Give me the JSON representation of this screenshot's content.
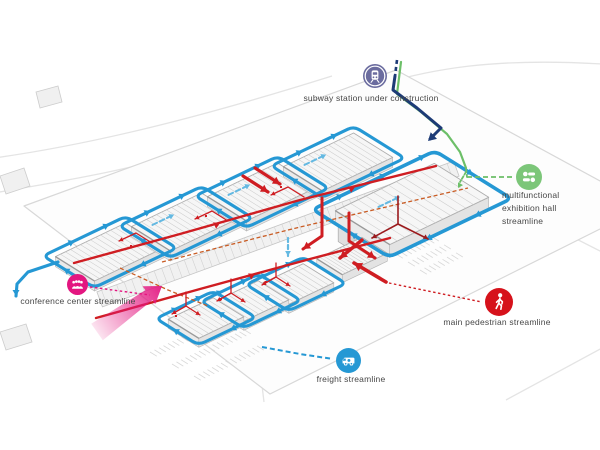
{
  "legend": {
    "subway": {
      "label": "subway station under construction",
      "color": "#6b6c9f",
      "icon": "train-icon"
    },
    "multifunctional": {
      "line1": "multifunctional",
      "line2": "exhibition hall",
      "line3": "streamline",
      "color": "#7cc679",
      "icon": "sliders-icon"
    },
    "conference": {
      "label": "conference center streamline",
      "color": "#e31680",
      "icon": "audience-icon"
    },
    "pedestrian": {
      "label": "main pedestrian streamline",
      "color": "#d6121b",
      "icon": "walking-person-icon"
    },
    "freight": {
      "label": "freight streamline",
      "color": "#2598d4",
      "icon": "truck-icon"
    }
  },
  "colors": {
    "freight_blue": "#2598d4",
    "freight_blue_light": "#64b9e2",
    "pedestrian_red": "#cf1d22",
    "dark_red": "#9b1b1e",
    "orange_dashed": "#c95c24",
    "subway_navy": "#1d3b76",
    "exhibition_green": "#6cbf68",
    "conference_magenta": "#e31680",
    "building_line": "#adadad",
    "ground_line": "#dadada"
  }
}
